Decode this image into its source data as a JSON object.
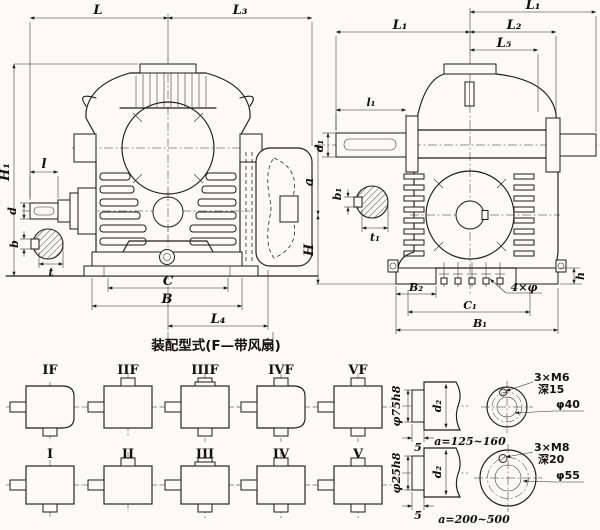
{
  "caption": "装配型式(F—带风扇)",
  "front_view": {
    "L": "L",
    "L3": "L₃",
    "H1": "H₁",
    "l": "l",
    "d": "d",
    "b": "b",
    "t": "t",
    "C": "C",
    "B": "B",
    "L4": "L₄"
  },
  "side_view": {
    "L1_right": "L₁",
    "L1_left": "L₁",
    "L2": "L₂",
    "L5": "L₅",
    "l1": "l₁",
    "d1": "d₁",
    "b1": "b₁",
    "t1": "t₁",
    "a": "a",
    "H": "H",
    "B2": "B₂",
    "C1": "C₁",
    "B1": "B₁",
    "foot_holes": "4×φ",
    "h": "h"
  },
  "configs": {
    "fan_row": [
      "IF",
      "IIF",
      "IIIF",
      "IVF",
      "VF"
    ],
    "plain_row": [
      "I",
      "II",
      "III",
      "IV",
      "V"
    ]
  },
  "shaft_details": [
    {
      "spigot_dia": "φ75h8",
      "spigot_len": "5",
      "shaft_dia": "d₂",
      "range": "a=125~160",
      "tapped": "3×M6",
      "depth": "深15",
      "bore": "φ40"
    },
    {
      "spigot_dia": "φ25h8",
      "spigot_len": "5",
      "shaft_dia": "d₂",
      "range": "a=200~500",
      "tapped": "3×M8",
      "depth": "深20",
      "bore": "φ55"
    }
  ]
}
